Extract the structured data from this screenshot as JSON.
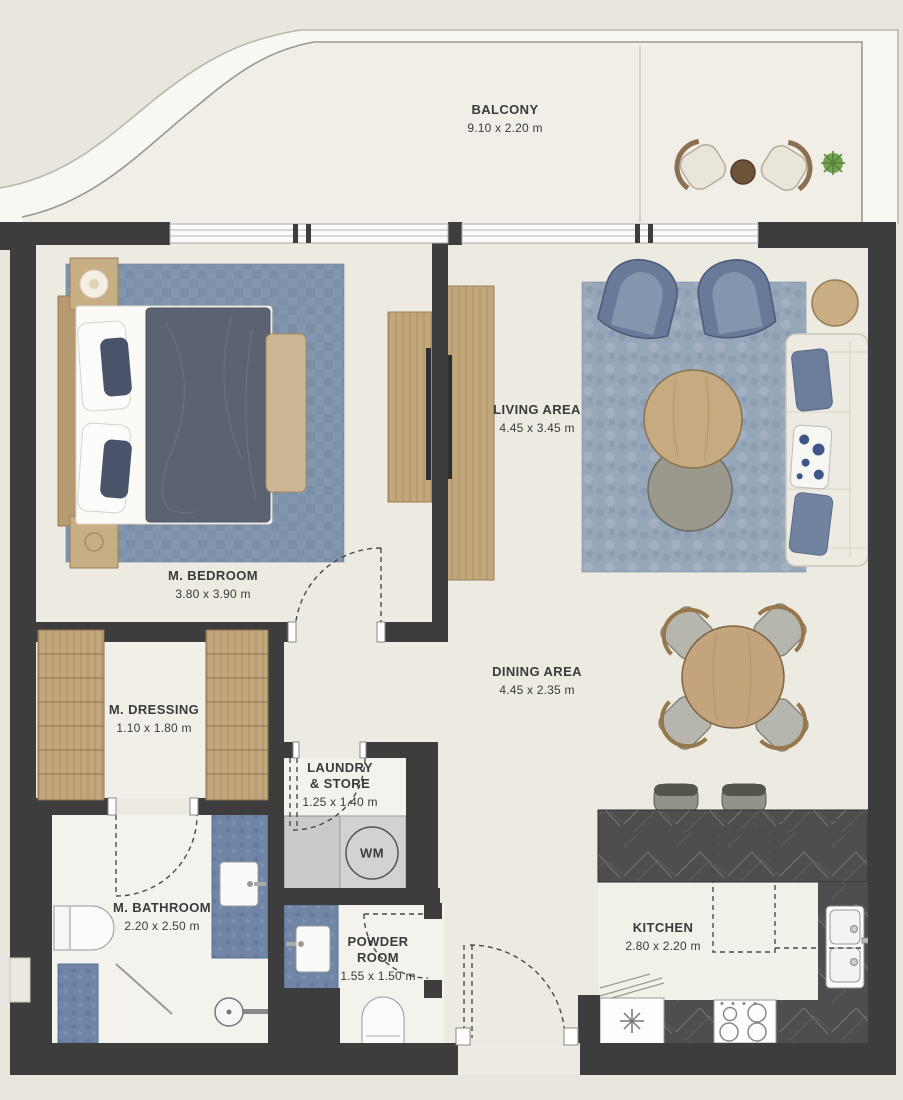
{
  "rooms": {
    "balcony": {
      "label": "BALCONY",
      "dims": "9.10 x 2.20 m"
    },
    "bedroom": {
      "label": "M. BEDROOM",
      "dims": "3.80 x 3.90 m"
    },
    "living": {
      "label": "LIVING AREA",
      "dims": "4.45 x 3.45 m"
    },
    "dining": {
      "label": "DINING AREA",
      "dims": "4.45 x 2.35 m"
    },
    "dressing": {
      "label": "M. DRESSING",
      "dims": "1.10 x 1.80 m"
    },
    "laundry": {
      "label_line1": "LAUNDRY",
      "label_line2": "& STORE",
      "dims": "1.25 x 1.40 m"
    },
    "bathroom": {
      "label": "M. BATHROOM",
      "dims": "2.20 x 2.50 m"
    },
    "powder": {
      "label_line1": "POWDER",
      "label_line2": "ROOM",
      "dims": "1.55 x 1.50 m"
    },
    "kitchen": {
      "label": "KITCHEN",
      "dims": "2.80 x 2.20 m"
    }
  },
  "appliances": {
    "washing_machine": "WM"
  },
  "colors": {
    "background": "#e9e6dd",
    "wall": "#3d3d3d",
    "rug_blue": "#8296ad",
    "wood": "#c5ab82",
    "marble": "#4e4e4e",
    "vanity_blue": "#7186a6",
    "duvet": "#5b6271",
    "armchair_blue": "#687a98"
  }
}
